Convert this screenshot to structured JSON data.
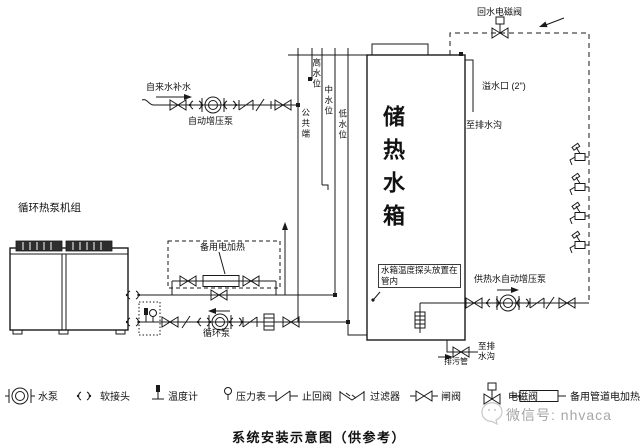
{
  "diagram": {
    "title": "系统安装示意图（供参考）",
    "wechat_id": "微信号: nhvaca",
    "labels": {
      "tap_water_makeup": "自来水补水",
      "auto_booster_pump": "自动增压泵",
      "return_solenoid_valve": "回水电磁阀",
      "overflow_port": "溢水口 (2\")",
      "to_drain_top": "至排水沟",
      "storage_tank": "储热水箱",
      "common_terminal": "公共端",
      "high_level": "高水位",
      "mid_level": "中水位",
      "low_level": "低水位",
      "heat_pump_unit": "循环热泵机组",
      "spare_electric_heater": "备用电加热",
      "circulation_pump": "循环泵",
      "hot_water_booster_pump": "供热水自动增压泵",
      "probe_note_line1": "水箱温度探头放置在",
      "probe_note_line2": "管内",
      "blowdown_pipe": "排污管",
      "to_drain_bottom_line1": "至排",
      "to_drain_bottom_line2": "水沟"
    },
    "legend": [
      {
        "name": "water-pump",
        "label": "水泵"
      },
      {
        "name": "flexible-joint",
        "label": "软接头"
      },
      {
        "name": "thermometer",
        "label": "温度计"
      },
      {
        "name": "pressure-gauge",
        "label": "压力表"
      },
      {
        "name": "check-valve",
        "label": "止回阀"
      },
      {
        "name": "filter",
        "label": "过滤器"
      },
      {
        "name": "gate-valve",
        "label": "闸阀"
      },
      {
        "name": "solenoid-valve",
        "label": "电磁阀"
      },
      {
        "name": "spare-pipe-heater",
        "label": "备用管道电加热"
      }
    ]
  }
}
